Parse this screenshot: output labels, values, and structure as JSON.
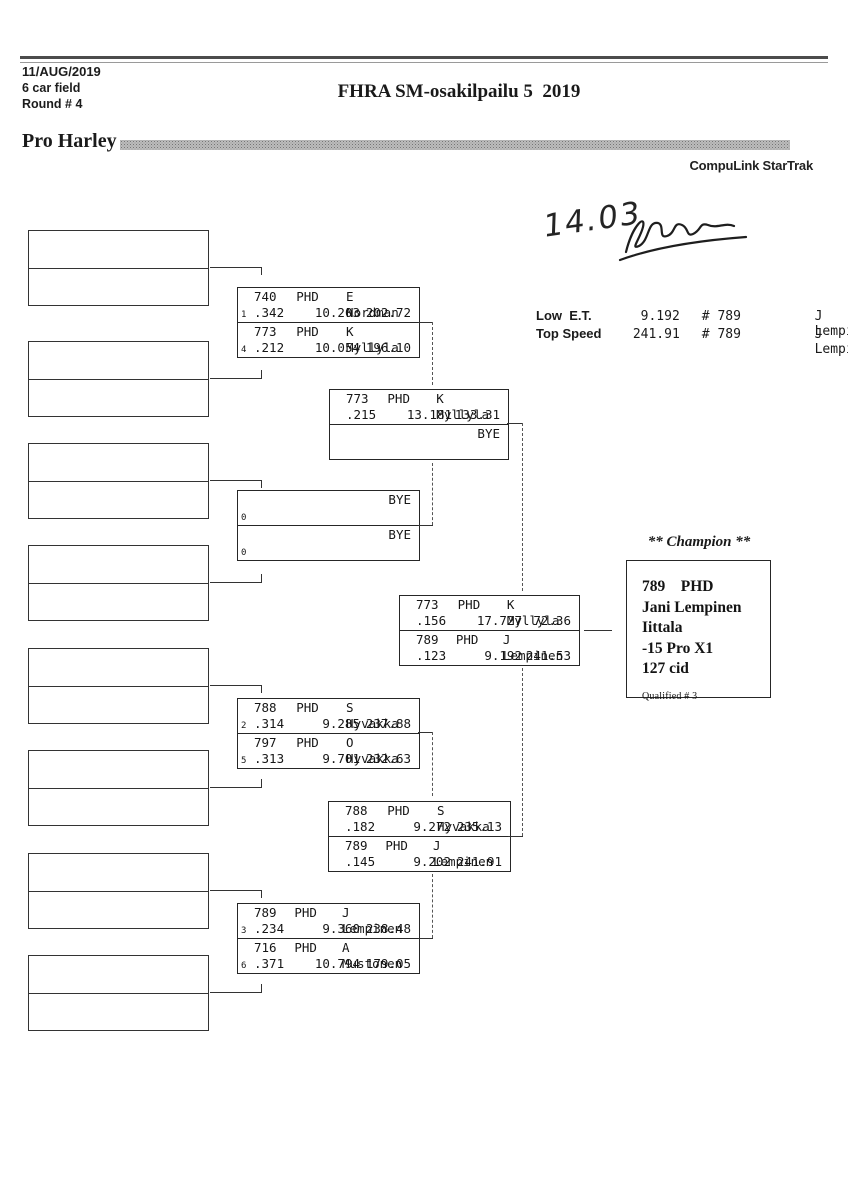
{
  "page": {
    "date": "11/AUG/2019",
    "field_size": "6 car field",
    "round": "Round # 4",
    "title": "FHRA SM-osakilpailu 5  2019",
    "category": "Pro Harley",
    "brand": "CompuLink StarTrak",
    "handwritten_time": "14.03"
  },
  "stats": {
    "rows": [
      {
        "label": "Low  E.T.",
        "value": "9.192",
        "car": "# 789",
        "driver": "J Lempinen"
      },
      {
        "label": "Top Speed",
        "value": "241.91",
        "car": "# 789",
        "driver": "J Lempinen"
      }
    ]
  },
  "bracket": {
    "round1": [
      {
        "top": {
          "car": "740",
          "cls": "PHD",
          "driver": "E Nordman",
          "seed": "1",
          "rt": ".342",
          "et": "10.203",
          "speed": "202.72"
        },
        "bottom": {
          "car": "773",
          "cls": "PHD",
          "driver": "K Myllyla",
          "seed": "4",
          "rt": ".212",
          "et": "10.054",
          "speed": "196.10"
        }
      },
      {
        "top": {
          "driver": "BYE",
          "seed": "0"
        },
        "bottom": {
          "driver": "BYE",
          "seed": "0"
        }
      },
      {
        "top": {
          "car": "788",
          "cls": "PHD",
          "driver": "S Hyvakka",
          "seed": "2",
          "rt": ".314",
          "et": "9.285",
          "speed": "237.88"
        },
        "bottom": {
          "car": "797",
          "cls": "PHD",
          "driver": "O Hyvakka",
          "seed": "5",
          "rt": ".313",
          "et": "9.701",
          "speed": "232.63"
        }
      },
      {
        "top": {
          "car": "789",
          "cls": "PHD",
          "driver": "J Lempinen",
          "seed": "3",
          "rt": ".234",
          "et": "9.360",
          "speed": "238.48"
        },
        "bottom": {
          "car": "716",
          "cls": "PHD",
          "driver": "A Mustonen",
          "seed": "6",
          "rt": ".371",
          "et": "10.794",
          "speed": "179.05"
        }
      }
    ],
    "semifinals": [
      {
        "top": {
          "car": "773",
          "cls": "PHD",
          "driver": "K Myllyla",
          "rt": ".215",
          "et": "13.181",
          "speed": "133.31"
        },
        "bottom": {
          "driver": "BYE"
        }
      },
      {
        "top": {
          "car": "788",
          "cls": "PHD",
          "driver": "S Hyvakka",
          "rt": ".182",
          "et": "9.272",
          "speed": "235.13"
        },
        "bottom": {
          "car": "789",
          "cls": "PHD",
          "driver": "J Lempinen",
          "rt": ".145",
          "et": "9.202",
          "speed": "241.91"
        }
      }
    ],
    "final": {
      "top": {
        "car": "773",
        "cls": "PHD",
        "driver": "K Myllyla",
        "rt": ".156",
        "et": "17.727",
        "speed": "72.36"
      },
      "bottom": {
        "car": "789",
        "cls": "PHD",
        "driver": "J Lempinen",
        "rt": ".123",
        "et": "9.192",
        "speed": "241.53"
      }
    },
    "champion": {
      "heading": "** Champion **",
      "car_class": "789    PHD",
      "name": "Jani Lempinen",
      "town": "Iittala",
      "entry": "-15 Pro X1",
      "engine": "127 cid",
      "qualified": "Qualified # 3"
    }
  }
}
